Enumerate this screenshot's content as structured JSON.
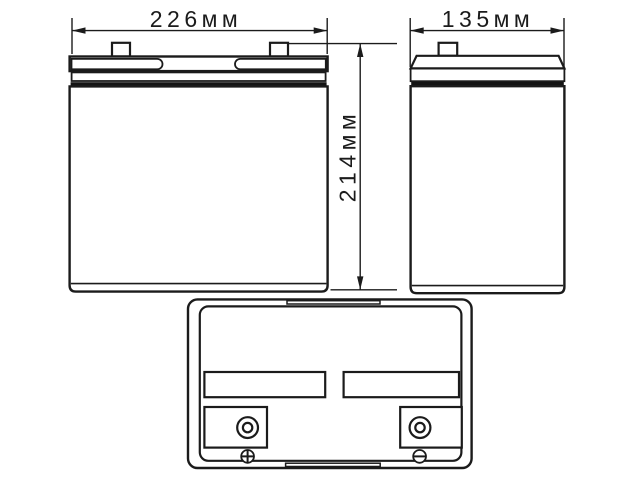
{
  "dims": {
    "width": {
      "label": "226мм",
      "mm": 226
    },
    "depth": {
      "label": "135мм",
      "mm": 135
    },
    "height": {
      "label": "214мм",
      "mm": 214
    }
  },
  "marks": {
    "positive": "+",
    "negative": "−"
  },
  "colors": {
    "line": "#1b1b1b",
    "thick_fill": "#141414",
    "background": "#ffffff"
  }
}
